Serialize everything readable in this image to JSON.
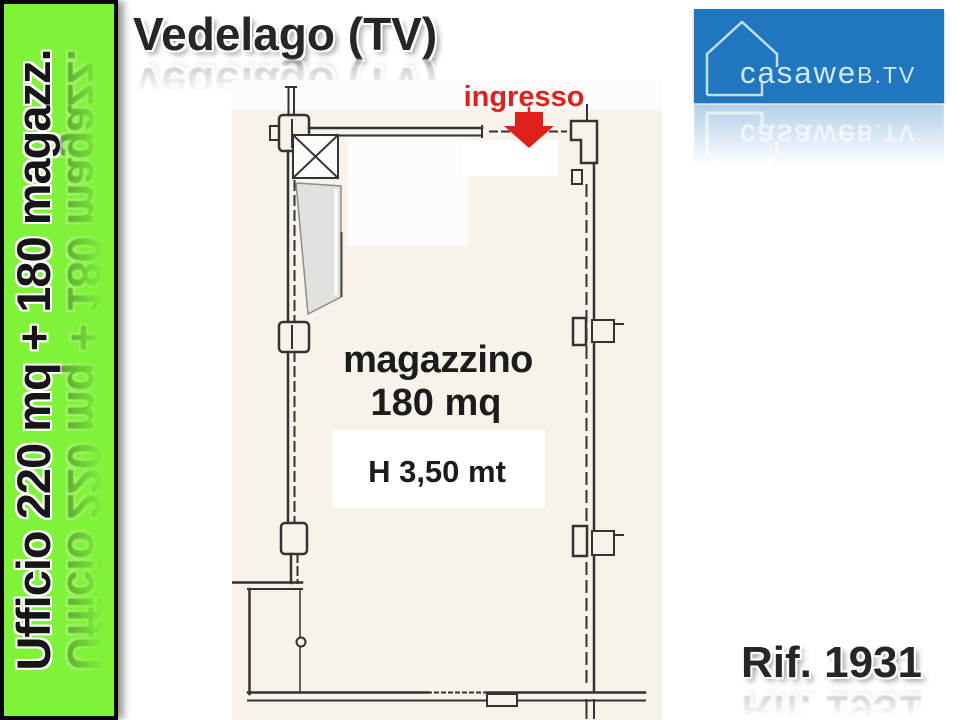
{
  "banner": {
    "label": "Ufficio 220 mq + 180 magazz.",
    "bg_color": "#80f23a",
    "text_color": "#161616"
  },
  "header": {
    "title": "Vedelago (TV)"
  },
  "logo": {
    "name": "casaweb.tv",
    "text_main": "casawe",
    "text_suffix": "b.tv",
    "bg_color": "#2176c0",
    "fg_color": "#cfe9fa",
    "icon": "house-outline-icon"
  },
  "reference": {
    "label": "Rif. 1931"
  },
  "floor_plan": {
    "entrance_label": "ingresso",
    "room_label": "magazzino",
    "area_label": "180 mq",
    "height_label": "H 3,50 mt",
    "entrance_color": "#e0201c",
    "paper_color": "#f7f2ea"
  }
}
